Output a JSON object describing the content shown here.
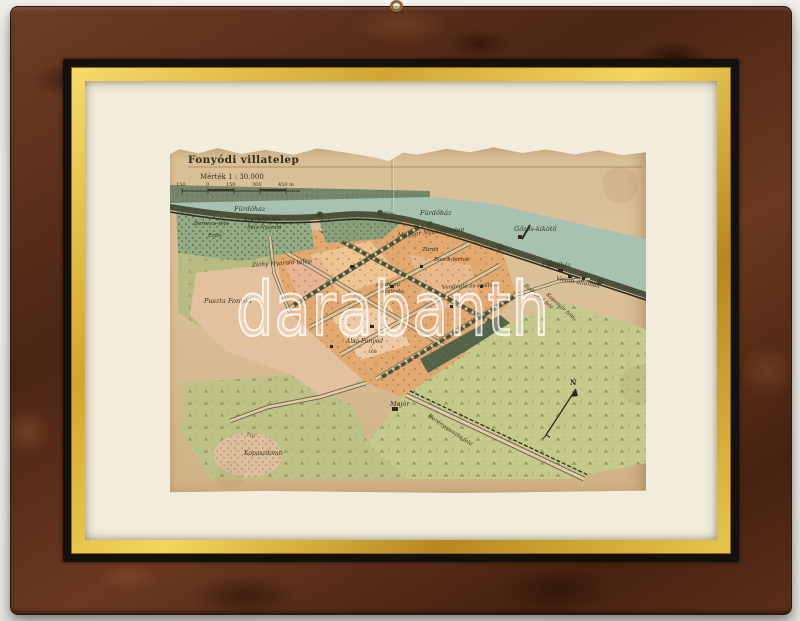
{
  "photo": {
    "subject": "framed antique map hanging photo"
  },
  "watermark": {
    "text": "darabanth"
  },
  "frame": {
    "wood_color": "#5c2f1a",
    "gold_fillet_color": "#e9c64e",
    "mat_color": "#f1ecdb",
    "paper_color": "#d8be95"
  },
  "map": {
    "title": "Fonyódi villatelep",
    "scale_statement": "Mérték 1 : 30.000",
    "colors": {
      "water": "#a8c2b2",
      "hills": "#798a70",
      "forest": "#93a981",
      "meadow": "#c6c98c",
      "village": "#e2a86f",
      "puszta": "#e3c1a0",
      "ink": "#33301f"
    },
    "north_indicator": "N",
    "labels": [
      {
        "t": "Fonyódi villatelep",
        "x": 18,
        "y": 18,
        "s": 10.5,
        "k": "title"
      },
      {
        "t": "Mérték 1 : 30.000",
        "x": 30,
        "y": 34,
        "s": 7,
        "k": "up"
      },
      {
        "t": "150",
        "x": 6,
        "y": 41,
        "s": 5,
        "k": "up"
      },
      {
        "t": "0",
        "x": 36,
        "y": 41,
        "s": 5,
        "k": "up"
      },
      {
        "t": "150",
        "x": 56,
        "y": 41,
        "s": 5,
        "k": "up"
      },
      {
        "t": "300",
        "x": 82,
        "y": 41,
        "s": 5,
        "k": "up"
      },
      {
        "t": "450 m",
        "x": 108,
        "y": 41,
        "s": 5,
        "k": "up"
      },
      {
        "t": "Fürdőház",
        "x": 64,
        "y": 66,
        "s": 6.5
      },
      {
        "t": "Fürdőház",
        "x": 250,
        "y": 70,
        "s": 6.5
      },
      {
        "t": "Gőzös-kikötő",
        "x": 344,
        "y": 86,
        "s": 6.5
      },
      {
        "t": "Fürdőház",
        "x": 372,
        "y": 122,
        "s": 6
      },
      {
        "t": "Vasúti állomás",
        "x": 386,
        "y": 135,
        "s": 6,
        "r": 10
      },
      {
        "t": "Budapest felé",
        "x": 354,
        "y": 141,
        "s": 5.2,
        "r": 40
      },
      {
        "t": "Kaposvár felé",
        "x": 376,
        "y": 150,
        "s": 5.2,
        "r": 42
      },
      {
        "t": "Berencs-féle",
        "x": 24,
        "y": 80,
        "s": 5.5
      },
      {
        "t": "Erdő",
        "x": 38,
        "y": 92,
        "s": 5.5
      },
      {
        "t": "Szunyogh-féle",
        "x": 74,
        "y": 76,
        "s": 5.2
      },
      {
        "t": "Béla Nyaraló",
        "x": 77,
        "y": 84,
        "s": 5.2
      },
      {
        "t": "Zichy Nyaraló telep",
        "x": 82,
        "y": 122,
        "s": 6,
        "r": -4
      },
      {
        "t": "Magyar Nyaraló telep",
        "x": 228,
        "y": 92,
        "s": 6,
        "r": -5
      },
      {
        "t": "Zárda",
        "x": 252,
        "y": 106,
        "s": 5.5
      },
      {
        "t": "Basch-birtok",
        "x": 264,
        "y": 116,
        "s": 5.5
      },
      {
        "t": "vendéglő",
        "x": 206,
        "y": 141,
        "s": 5.2
      },
      {
        "t": "szálloda",
        "x": 212,
        "y": 148,
        "s": 5.2
      },
      {
        "t": "Vendéglő és szálloda",
        "x": 272,
        "y": 144,
        "s": 5.5,
        "r": -3
      },
      {
        "t": "Alsó-Fonyód",
        "x": 176,
        "y": 198,
        "s": 6
      },
      {
        "t": "Puszta Fonyód",
        "x": 34,
        "y": 158,
        "s": 6.5
      },
      {
        "t": "Major",
        "x": 220,
        "y": 261,
        "s": 6.5
      },
      {
        "t": "Berény puszta felé",
        "x": 258,
        "y": 272,
        "s": 5.5,
        "r": 34
      },
      {
        "t": "Kopaszdomb",
        "x": 74,
        "y": 310,
        "s": 6
      },
      {
        "t": "N",
        "x": 400,
        "y": 240,
        "s": 7,
        "k": "b"
      },
      {
        "t": "160",
        "x": 198,
        "y": 208,
        "s": 4.5,
        "k": "up"
      },
      {
        "t": "110",
        "x": 76,
        "y": 290,
        "s": 4.5,
        "k": "up",
        "r": 20
      }
    ]
  }
}
